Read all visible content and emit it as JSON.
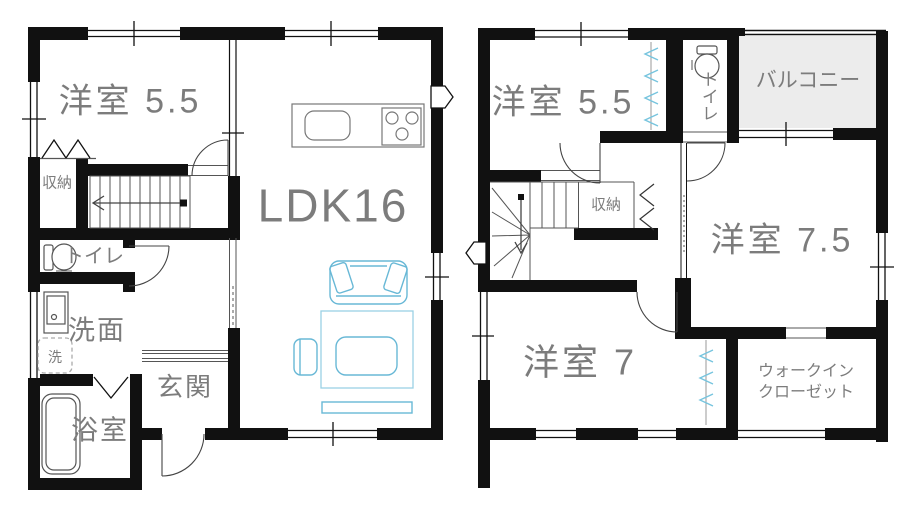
{
  "colors": {
    "wall": "#111111",
    "label_text": "#7c7c7c",
    "furniture_stroke": "#68b8d6",
    "zigzag_stroke": "#76c4de",
    "balcony_fill": "#ececec"
  },
  "floor1": {
    "western_room": "洋室 5.5",
    "ldk": "LDK16",
    "closet": "収納",
    "toilet": "トイレ",
    "washroom": "洗面",
    "washing_machine": "洗",
    "bathroom": "浴室",
    "entrance": "玄関"
  },
  "floor2": {
    "western_room_small": "洋室 5.5",
    "toilet": "トイレ",
    "balcony": "バルコニー",
    "closet": "収納",
    "western_room_large": "洋室 7.5",
    "western_room_mid": "洋室 7",
    "walk_in_closet_line1": "ウォークイン",
    "walk_in_closet_line2": "クローゼット"
  }
}
